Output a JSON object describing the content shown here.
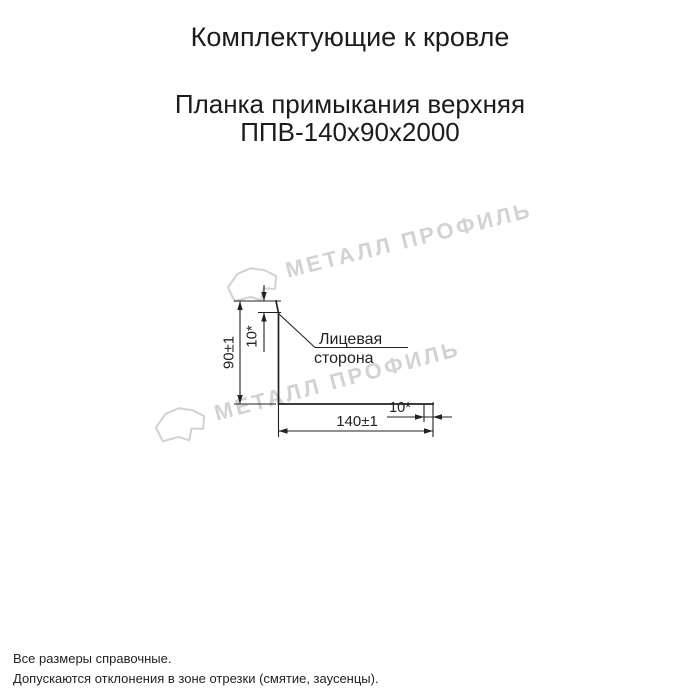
{
  "page": {
    "title": "Комплектующие к кровле",
    "product_name": "Планка примыкания верхняя",
    "product_code": "ППВ-140х90х2000"
  },
  "drawing": {
    "dim_height": "90±1",
    "dim_top_hem": "10*",
    "dim_width": "140±1",
    "dim_end_hem": "10*",
    "face_side_label_line1": "Лицевая",
    "face_side_label_line2": "сторона"
  },
  "watermark": {
    "text": "МЕТАЛЛ ПРОФИЛЬ",
    "color": "#d2d2d2"
  },
  "footnotes": {
    "line1": "Все размеры справочные.",
    "line2": "Допускаются отклонения в зоне отрезки (смятие, заусенцы)."
  }
}
